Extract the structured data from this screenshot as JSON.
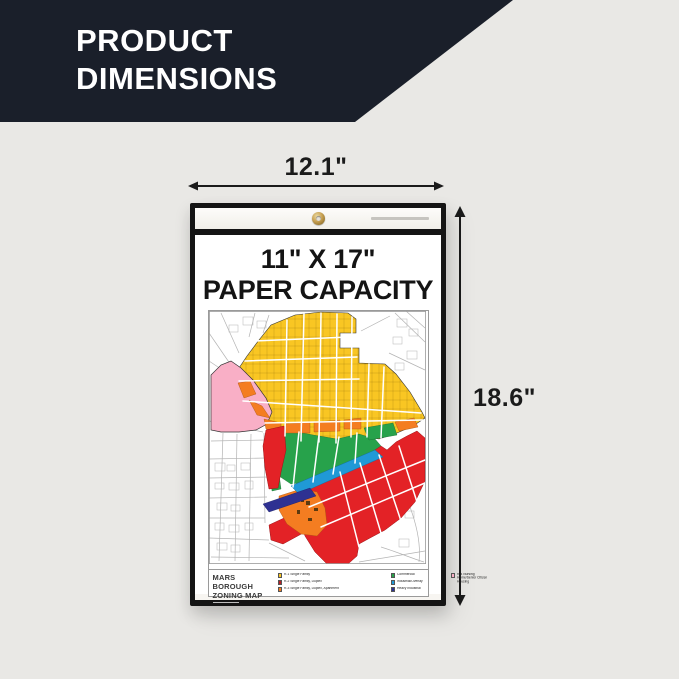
{
  "banner": {
    "line1": "PRODUCT",
    "line2": "DIMENSIONS"
  },
  "dims": {
    "width": "12.1\"",
    "height": "18.6\""
  },
  "product": {
    "headline1": "11\" X 17\"",
    "headline2": "PAPER CAPACITY"
  },
  "map": {
    "title1": "MARS BOROUGH",
    "title2": "ZONING MAP",
    "legend": [
      {
        "label": "R-1 Single Family",
        "color": "#F9C623"
      },
      {
        "label": "R-2 Single Family, Duplex",
        "color": "#B81F26"
      },
      {
        "label": "R-3 Single Family, Duplex, Apartment",
        "color": "#F47D21"
      },
      {
        "label": "Commercial",
        "color": "#27A24B"
      },
      {
        "label": "Industrial/Overlay",
        "color": "#2099D6"
      },
      {
        "label": "Heavy Industrial",
        "color": "#2E3192"
      },
      {
        "label": "R-4 Nursing Home/Senior Citizen Housing",
        "color": "#F9AFC6"
      }
    ]
  },
  "colors": {
    "yellow": "#F9C623",
    "pink": "#F9AFC6",
    "orange": "#F47D21",
    "red": "#E32226",
    "green": "#27A24B",
    "cyan": "#2099D6",
    "navy": "#2E3192",
    "brown": "#5C3A10",
    "banner_bg": "#1A1F2A",
    "page_bg": "#E9E8E5"
  }
}
